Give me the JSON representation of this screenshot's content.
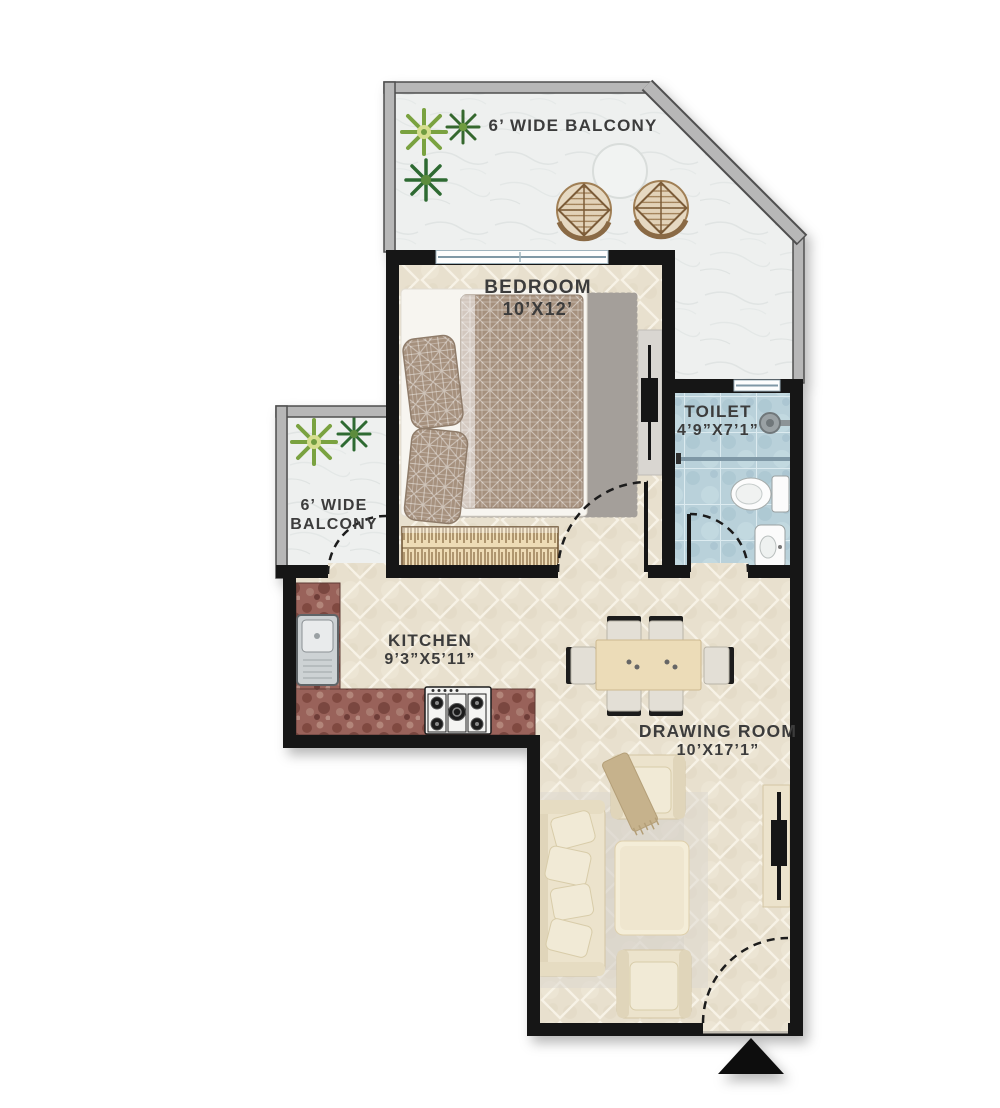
{
  "rooms": {
    "balcony_top": {
      "label": "6’ WIDE BALCONY"
    },
    "bedroom": {
      "label": "BEDROOM",
      "size": "10’X12’"
    },
    "toilet": {
      "label": "TOILET",
      "size": "4’9”X7’1”"
    },
    "balcony_left": {
      "label_line1": "6’ WIDE",
      "label_line2": "BALCONY"
    },
    "kitchen": {
      "label": "KITCHEN",
      "size": "9’3”X5’11”"
    },
    "drawing_room": {
      "label": "DRAWING ROOM",
      "size": "10’X17’1”"
    }
  },
  "colors": {
    "wall": "#161616",
    "balcony_wall": "#b7b7b7",
    "floor_tile_beige": "#e8e0ce",
    "toilet_tile_blue": "#b9d1da",
    "granite_counter": "#99625a",
    "marble_white": "#eef0ef",
    "label_text": "#3c3c3c"
  },
  "icons": {
    "compass": "north-arrow-icon",
    "bed": "double-bed-icon",
    "wardrobe": "wardrobe-icon",
    "tv": "tv-icon",
    "sofa": "sofa-icon",
    "armchair": "armchair-icon",
    "coffee_table": "coffee-table-icon",
    "dining_table": "dining-table-icon",
    "sink": "kitchen-sink-icon",
    "stove": "gas-stove-icon",
    "wc": "toilet-wc-icon",
    "washbasin": "washbasin-icon",
    "shower": "shower-head-icon",
    "plant": "plant-icon",
    "patio_table": "patio-table-icon",
    "patio_chair": "patio-chair-icon",
    "door": "door-swing-icon",
    "window": "window-icon"
  }
}
